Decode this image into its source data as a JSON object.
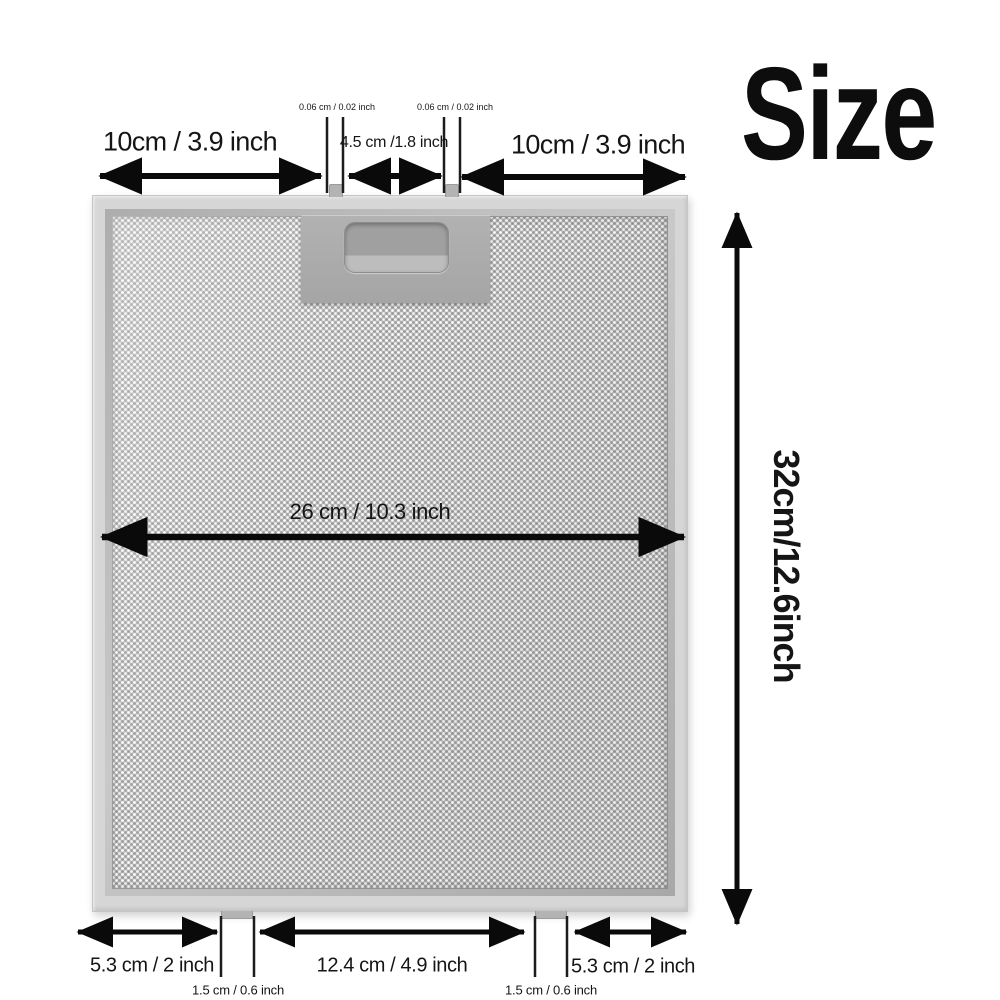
{
  "size_label": "Size",
  "dims": {
    "top_left": "10cm / 3.9 inch",
    "pin_left": "0.06 cm / 0.02 inch",
    "handle_gap": "4.5 cm /1.8 inch",
    "pin_right": "0.06 cm / 0.02 inch",
    "top_right": "10cm / 3.9 inch",
    "width": "26 cm / 10.3 inch",
    "height": "32cm/12.6inch",
    "bottom_left": "5.3 cm / 2 inch",
    "tab_left": "1.5 cm / 0.6 inch",
    "bottom_center": "12.4 cm / 4.9 inch",
    "tab_right": "1.5 cm / 0.6 inch",
    "bottom_right": "5.3 cm / 2 inch"
  },
  "colors": {
    "background": "#ffffff",
    "frame": "#d6d6d6",
    "mesh_base": "#bcbcbc",
    "handle_plate": "#a9a9a9",
    "dimension_lines": "#0a0a0a",
    "text": "#151515"
  }
}
